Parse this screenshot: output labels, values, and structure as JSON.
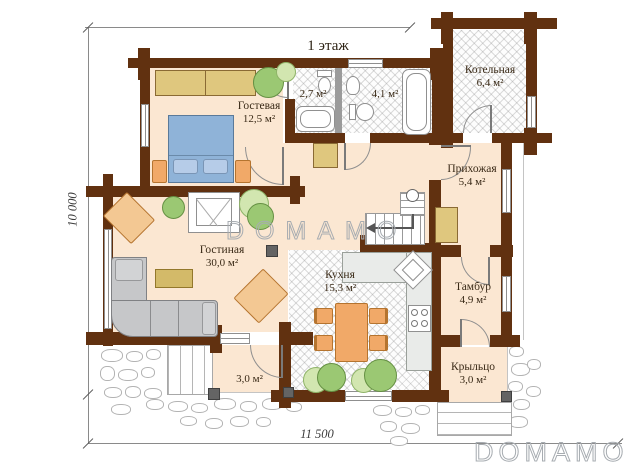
{
  "title": "1 этаж",
  "dimensions": {
    "height_label": "10 000",
    "width_label": "11 500"
  },
  "watermark": {
    "center": "DOMAMO",
    "corner": "DOMAMO"
  },
  "rooms": {
    "guest": {
      "name": "Гостевая",
      "area": "12,5 м²"
    },
    "boiler": {
      "name": "Котельная",
      "area": "6,4 м²"
    },
    "bath_small": {
      "area": "2,7 м²"
    },
    "bath_large": {
      "area": "4,1 м²"
    },
    "hallway": {
      "name": "Прихожая",
      "area": "5,4 м²"
    },
    "living": {
      "name": "Гостиная",
      "area": "30,0 м²"
    },
    "kitchen": {
      "name": "Кухня",
      "area": "15,3 м²"
    },
    "vestibule": {
      "name": "Тамбур",
      "area": "4,9 м²"
    },
    "porch": {
      "name": "Крыльцо",
      "area": "3,0 м²"
    },
    "terrace": {
      "area": "3,0 м²"
    }
  },
  "colors": {
    "wall": "#613110",
    "floor": "#fbe7d2",
    "wood": "#dfc77e",
    "bed": "#8fb3d8",
    "sofa": "#c6c7c9",
    "orange": "#f1a968",
    "plant": "#9bc873",
    "plant-light": "#d2e6b0",
    "label": "#3a2a17",
    "watermark": "#a7acb1"
  }
}
